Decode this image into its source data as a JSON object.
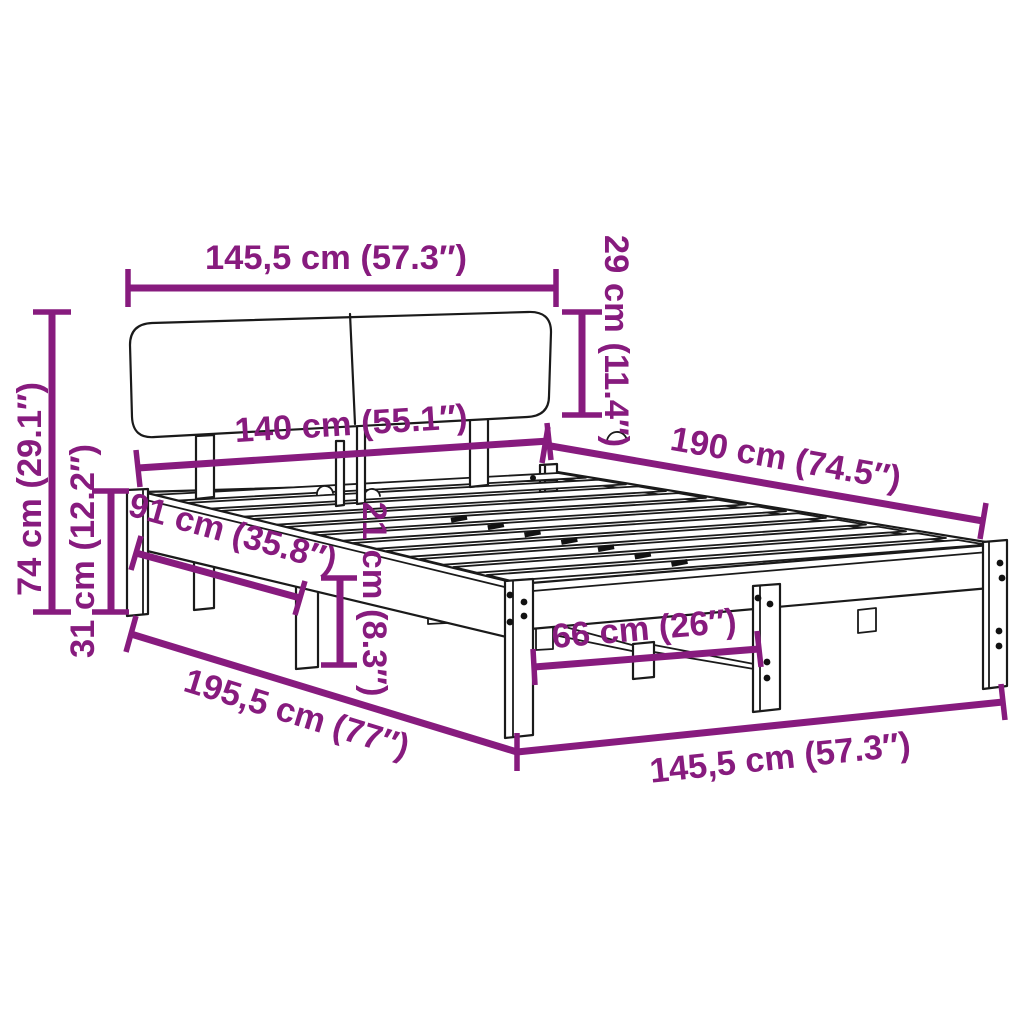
{
  "diagram": {
    "title": "bed-frame-with-headboard-dimension-diagram",
    "accent_color": "#871B7E",
    "line_color": "#1A1A1A",
    "background_color": "#FFFFFF",
    "dimensions": [
      {
        "id": "headboard-width",
        "label": "145,5 cm (57.3″)"
      },
      {
        "id": "headboard-height",
        "label": "29 cm (11.4″)"
      },
      {
        "id": "inner-width",
        "label": "140 cm (55.1″)"
      },
      {
        "id": "mattress-length",
        "label": "190 cm (74.5″)"
      },
      {
        "id": "total-height",
        "label": "74 cm (29.1″)"
      },
      {
        "id": "base-height",
        "label": "31 cm (12.2″)"
      },
      {
        "id": "side-leg-spacing",
        "label": "91 cm (35.8″)"
      },
      {
        "id": "frame-thickness",
        "label": "21 cm (8.3″)"
      },
      {
        "id": "foot-leg-spacing",
        "label": "66 cm (26″)"
      },
      {
        "id": "total-length",
        "label": "195,5 cm (77″)"
      },
      {
        "id": "total-width",
        "label": "145,5 cm (57.3″)"
      }
    ]
  }
}
